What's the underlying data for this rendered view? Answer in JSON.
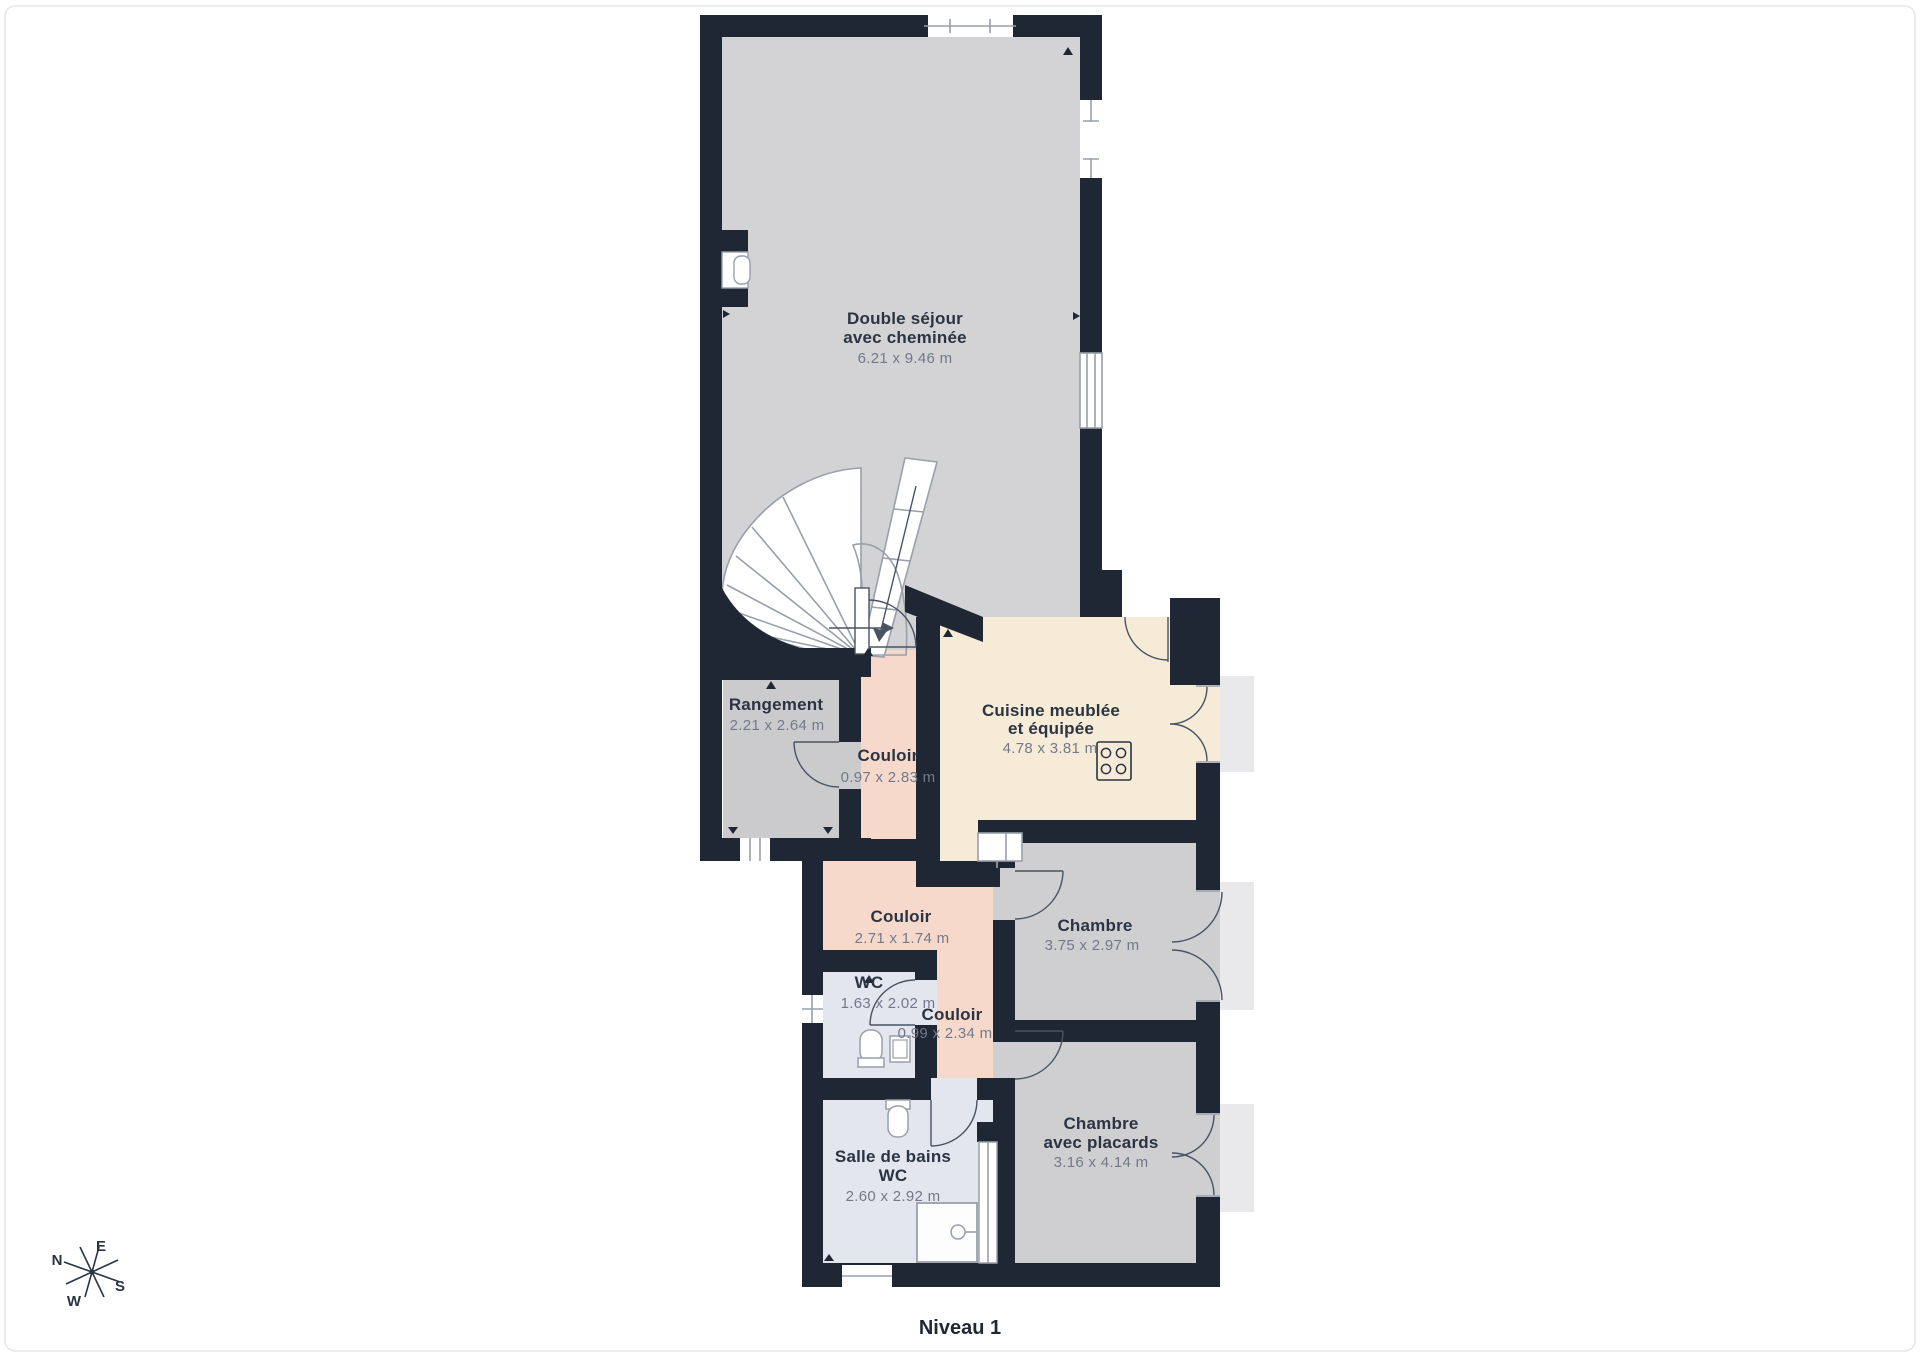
{
  "plan": {
    "caption": "Niveau 1",
    "rooms": {
      "sejour": {
        "name_line1": "Double séjour",
        "name_line2": "avec cheminée",
        "dims": "6.21 x 9.46 m"
      },
      "rangement": {
        "name": "Rangement",
        "dims": "2.21 x 2.64 m"
      },
      "couloir_haut": {
        "name": "Couloir",
        "dims": "0.97 x 2.83 m"
      },
      "cuisine": {
        "name_line1": "Cuisine meublée",
        "name_line2": "et équipée",
        "dims": "4.78 x 3.81 m"
      },
      "couloir_milieu": {
        "name": "Couloir",
        "dims": "2.71 x 1.74 m"
      },
      "chambre": {
        "name": "Chambre",
        "dims": "3.75 x 2.97 m"
      },
      "wc": {
        "name": "WC",
        "dims": "1.63 x 2.02 m"
      },
      "couloir_bas": {
        "name": "Couloir",
        "dims": "0.99 x 2.34 m"
      },
      "salle_de_bains": {
        "name_line1": "Salle de bains",
        "name_line2": "WC",
        "dims": "2.60 x 2.92 m"
      },
      "chambre_placards": {
        "name_line1": "Chambre",
        "name_line2": "avec placards",
        "dims": "3.16 x 4.14 m"
      }
    },
    "compass": {
      "north": "N",
      "east": "E",
      "south": "S",
      "west": "W"
    },
    "colors": {
      "wall": "#1e2733",
      "floor_living": "#d3d3d6",
      "floor_bedroom": "#cfcfd2",
      "floor_storage": "#cbcbce",
      "floor_corridor": "#f6d9cb",
      "floor_kitchen": "#f6ebd6",
      "floor_bathroom": "#e3e6ee",
      "exterior_step": "#e9e9ec",
      "outline": "#99a0aa",
      "door_arc": "#4a5363",
      "label_text": "#2b3442",
      "dims_text": "#72798a"
    }
  }
}
